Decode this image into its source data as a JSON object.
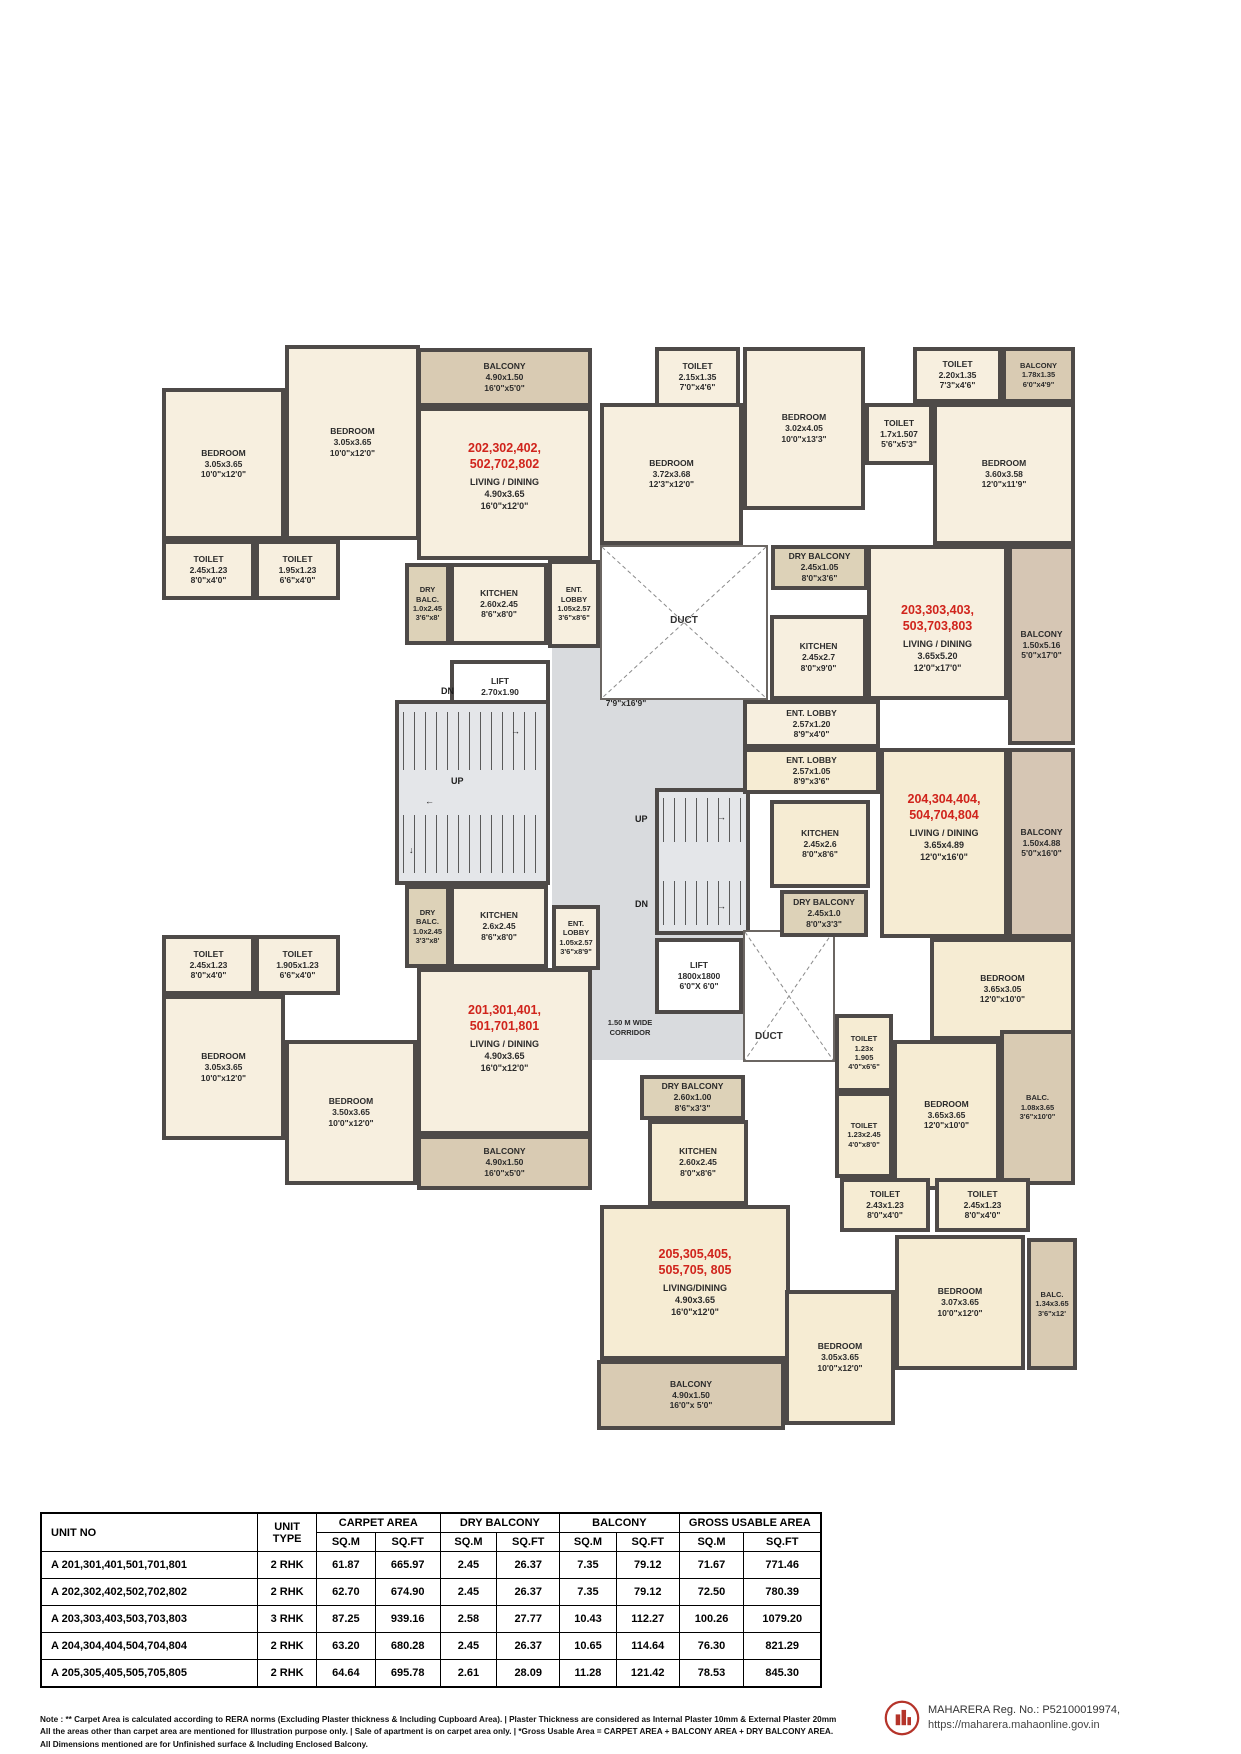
{
  "plan": {
    "corridor_label": "1.50 M WIDE\nCORRIDOR",
    "stairs": {
      "up": "UP",
      "dn": "DN"
    },
    "ducts": {
      "top": "DUCT",
      "bottom": "DUCT"
    },
    "rooms": {
      "bed_202_a": "BEDROOM\n3.05x3.65\n10'0\"x12'0\"",
      "bed_202_b": "BEDROOM\n3.05x3.65\n10'0\"x12'0\"",
      "balc_202_top": "BALCONY\n4.90x1.50\n16'0\"x5'0\"",
      "toilet_202_a": "TOILET\n2.45x1.23\n8'0\"x4'0\"",
      "toilet_202_b": "TOILET\n1.95x1.23\n6'6\"x4'0\"",
      "dryb_202": "DRY\nBALC.\n1.0x2.45\n3'6\"x8'",
      "kitchen_202": "KITCHEN\n2.60x2.45\n8'6\"x8'0\"",
      "entlobby_202": "ENT.\nLOBBY\n1.05x2.57\n3'6\"x8'6\"",
      "lift_main": "LIFT\n2.70x1.90\n8'9\"x6'0\"",
      "lift_lobby": "LIFT LOBBY\n2375 x 5125\n7'9\"x16'9\"",
      "toilet_203_a": "TOILET\n2.15x1.35\n7'0\"x4'6\"",
      "bed_203_a": "BEDROOM\n3.72x3.68\n12'3\"x12'0\"",
      "bed_203_b": "BEDROOM\n3.02x4.05\n10'0\"x13'3\"",
      "toilet_203_b": "TOILET\n2.20x1.35\n7'3\"x4'6\"",
      "balc_203_corner": "BALCONY\n1.78x1.35\n6'0\"x4'9\"",
      "toilet_203_c": "TOILET\n1.7x1.507\n5'6\"x5'3\"",
      "bed_203_c": "BEDROOM\n3.60x3.58\n12'0\"x11'9\"",
      "dryb_203": "DRY BALCONY\n2.45x1.05\n8'0\"x3'6\"",
      "kitchen_203": "KITCHEN\n2.45x2.7\n8'0\"x9'0\"",
      "balc_203_side": "BALCONY\n1.50x5.16\n5'0\"x17'0\"",
      "entlobby_203": "ENT. LOBBY\n2.57x1.20\n8'9\"x4'0\"",
      "entlobby_204": "ENT. LOBBY\n2.57x1.05\n8'9\"x3'6\"",
      "kitchen_204": "KITCHEN\n2.45x2.6\n8'0\"x8'6\"",
      "balc_204_side": "BALCONY\n1.50x4.88\n5'0\"x16'0\"",
      "dryb_204": "DRY BALCONY\n2.45x1.0\n8'0\"x3'3\"",
      "bed_204_a": "BEDROOM\n3.65x3.05\n12'0\"x10'0\"",
      "toilet_204_a": "TOILET\n1.23x\n1.905\n4'0\"x6'6\"",
      "bed_204_b": "BEDROOM\n3.65x3.65\n12'0\"x10'0\"",
      "balc_204_small": "BALC.\n1.08x3.65\n3'6\"x10'0\"",
      "toilet_204_b": "TOILET\n1.23x2.45\n4'0\"x8'0\"",
      "lift_small": "LIFT\n1800x1800\n6'0\"X 6'0\"",
      "toilet_201_a": "TOILET\n2.45x1.23\n8'0\"x4'0\"",
      "toilet_201_b": "TOILET\n1.905x1.23\n6'6\"x4'0\"",
      "dryb_201": "DRY\nBALC.\n1.0x2.45\n3'3\"x8'",
      "kitchen_201": "KITCHEN\n2.6x2.45\n8'6\"x8'0\"",
      "entlobby_201": "ENT.\nLOBBY\n1.05x2.57\n3'6\"x8'9\"",
      "bed_201_a": "BEDROOM\n3.05x3.65\n10'0\"x12'0\"",
      "bed_201_b": "BEDROOM\n3.50x3.65\n10'0\"x12'0\"",
      "balc_201": "BALCONY\n4.90x1.50\n16'0\"x5'0\"",
      "dryb_205": "DRY BALCONY\n2.60x1.00\n8'6\"x3'3\"",
      "kitchen_205": "KITCHEN\n2.60x2.45\n8'0\"x8'6\"",
      "toilet_205_a": "TOILET\n2.43x1.23\n8'0\"x4'0\"",
      "toilet_205_b": "TOILET\n2.45x1.23\n8'0\"x4'0\"",
      "bed_205_a": "BEDROOM\n3.07x3.65\n10'0\"x12'0\"",
      "balc_205_small": "BALC.\n1.34x3.65\n3'6\"x12'",
      "bed_205_b": "BEDROOM\n3.05x3.65\n10'0\"x12'0\"",
      "balc_205": "BALCONY\n4.90x1.50\n16'0\"x 5'0\""
    },
    "units": {
      "u201": {
        "label": "201,301,401,\n501,701,801",
        "living": "LIVING / DINING\n4.90x3.65\n16'0\"x12'0\""
      },
      "u202": {
        "label": "202,302,402,\n502,702,802",
        "living": "LIVING / DINING\n4.90x3.65\n16'0\"x12'0\""
      },
      "u203": {
        "label": "203,303,403,\n503,703,803",
        "living": "LIVING / DINING\n3.65x5.20\n12'0\"x17'0\""
      },
      "u204": {
        "label": "204,304,404,\n504,704,804",
        "living": "LIVING / DINING\n3.65x4.89\n12'0\"x16'0\""
      },
      "u205": {
        "label": "205,305,405,\n505,705, 805",
        "living": "LIVING/DINING\n4.90x3.65\n16'0\"x12'0\""
      }
    }
  },
  "table": {
    "col_unit_no": "UNIT NO",
    "col_unit_type": "UNIT\nTYPE",
    "groups": [
      "CARPET AREA",
      "DRY BALCONY",
      "BALCONY",
      "GROSS USABLE AREA"
    ],
    "sub_m": "SQ.M",
    "sub_ft": "SQ.FT",
    "rows": [
      {
        "cells": [
          "A 201,301,401,501,701,801",
          "2 RHK",
          "61.87",
          "665.97",
          "2.45",
          "26.37",
          "7.35",
          "79.12",
          "71.67",
          "771.46"
        ]
      },
      {
        "cells": [
          "A 202,302,402,502,702,802",
          "2 RHK",
          "62.70",
          "674.90",
          "2.45",
          "26.37",
          "7.35",
          "79.12",
          "72.50",
          "780.39"
        ]
      },
      {
        "cells": [
          "A 203,303,403,503,703,803",
          "3 RHK",
          "87.25",
          "939.16",
          "2.58",
          "27.77",
          "10.43",
          "112.27",
          "100.26",
          "1079.20"
        ]
      },
      {
        "cells": [
          "A 204,304,404,504,704,804",
          "2 RHK",
          "63.20",
          "680.28",
          "2.45",
          "26.37",
          "10.65",
          "114.64",
          "76.30",
          "821.29"
        ]
      },
      {
        "cells": [
          "A 205,305,405,505,705,805",
          "2 RHK",
          "64.64",
          "695.78",
          "2.61",
          "28.09",
          "11.28",
          "121.42",
          "78.53",
          "845.30"
        ]
      }
    ]
  },
  "footer": {
    "note1": "Note :  ** Carpet Area is calculated according to RERA norms (Excluding Plaster thickness & Including Cupboard Area).   |   Plaster Thickness are considered as Internal Plaster 10mm & External Plaster 20mm",
    "note2": "All the areas other than carpet area are mentioned for Illustration purpose only.   |   Sale of apartment is on carpet area only.   |   *Gross Usable Area = CARPET AREA + BALCONY AREA + DRY BALCONY AREA.",
    "note3": "All Dimensions mentioned are for Unfinished surface & Including Enclosed  Balcony.",
    "rera_line1": "MAHARERA Reg. No.: P52100019974,",
    "rera_line2": "https://maharera.mahaonline.gov.in"
  }
}
